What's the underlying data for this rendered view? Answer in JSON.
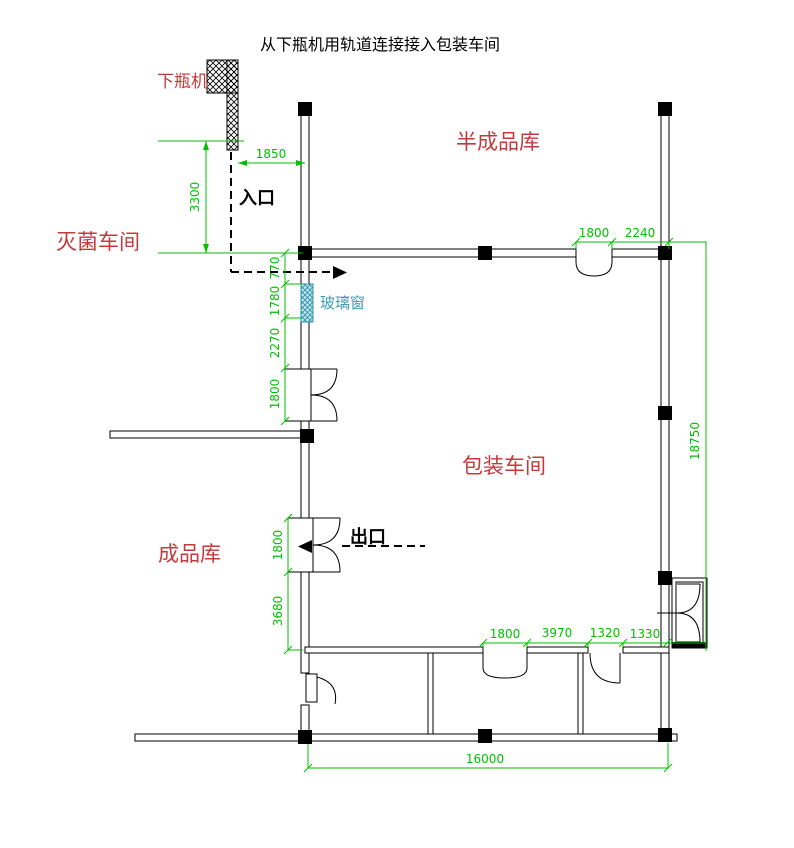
{
  "title": "从下瓶机用轨道连接接入包装车间",
  "labels": {
    "bottle_unloader": "下瓶机",
    "semi_finished_warehouse": "半成品库",
    "sterilization_workshop": "灭菌车间",
    "packaging_workshop": "包装车间",
    "finished_goods_warehouse": "成品库",
    "entrance": "入口",
    "exit": "出口",
    "glass_window": "玻璃窗"
  },
  "dims": {
    "track_offset": "1850",
    "track_length": "3300",
    "left_chain": [
      "770",
      "1780",
      "2270",
      "1800"
    ],
    "exit_chain": [
      "1800",
      "3680"
    ],
    "top_chain": [
      "1800",
      "2240"
    ],
    "right_overall": "18750",
    "bottom_chain": [
      "1800",
      "3970",
      "1320",
      "1330"
    ],
    "bottom_overall": "16000"
  },
  "colors": {
    "dimension_green": "#00C000",
    "label_red": "#C23B3B",
    "window_teal": "#3A9DB5",
    "line_black": "#000000"
  }
}
